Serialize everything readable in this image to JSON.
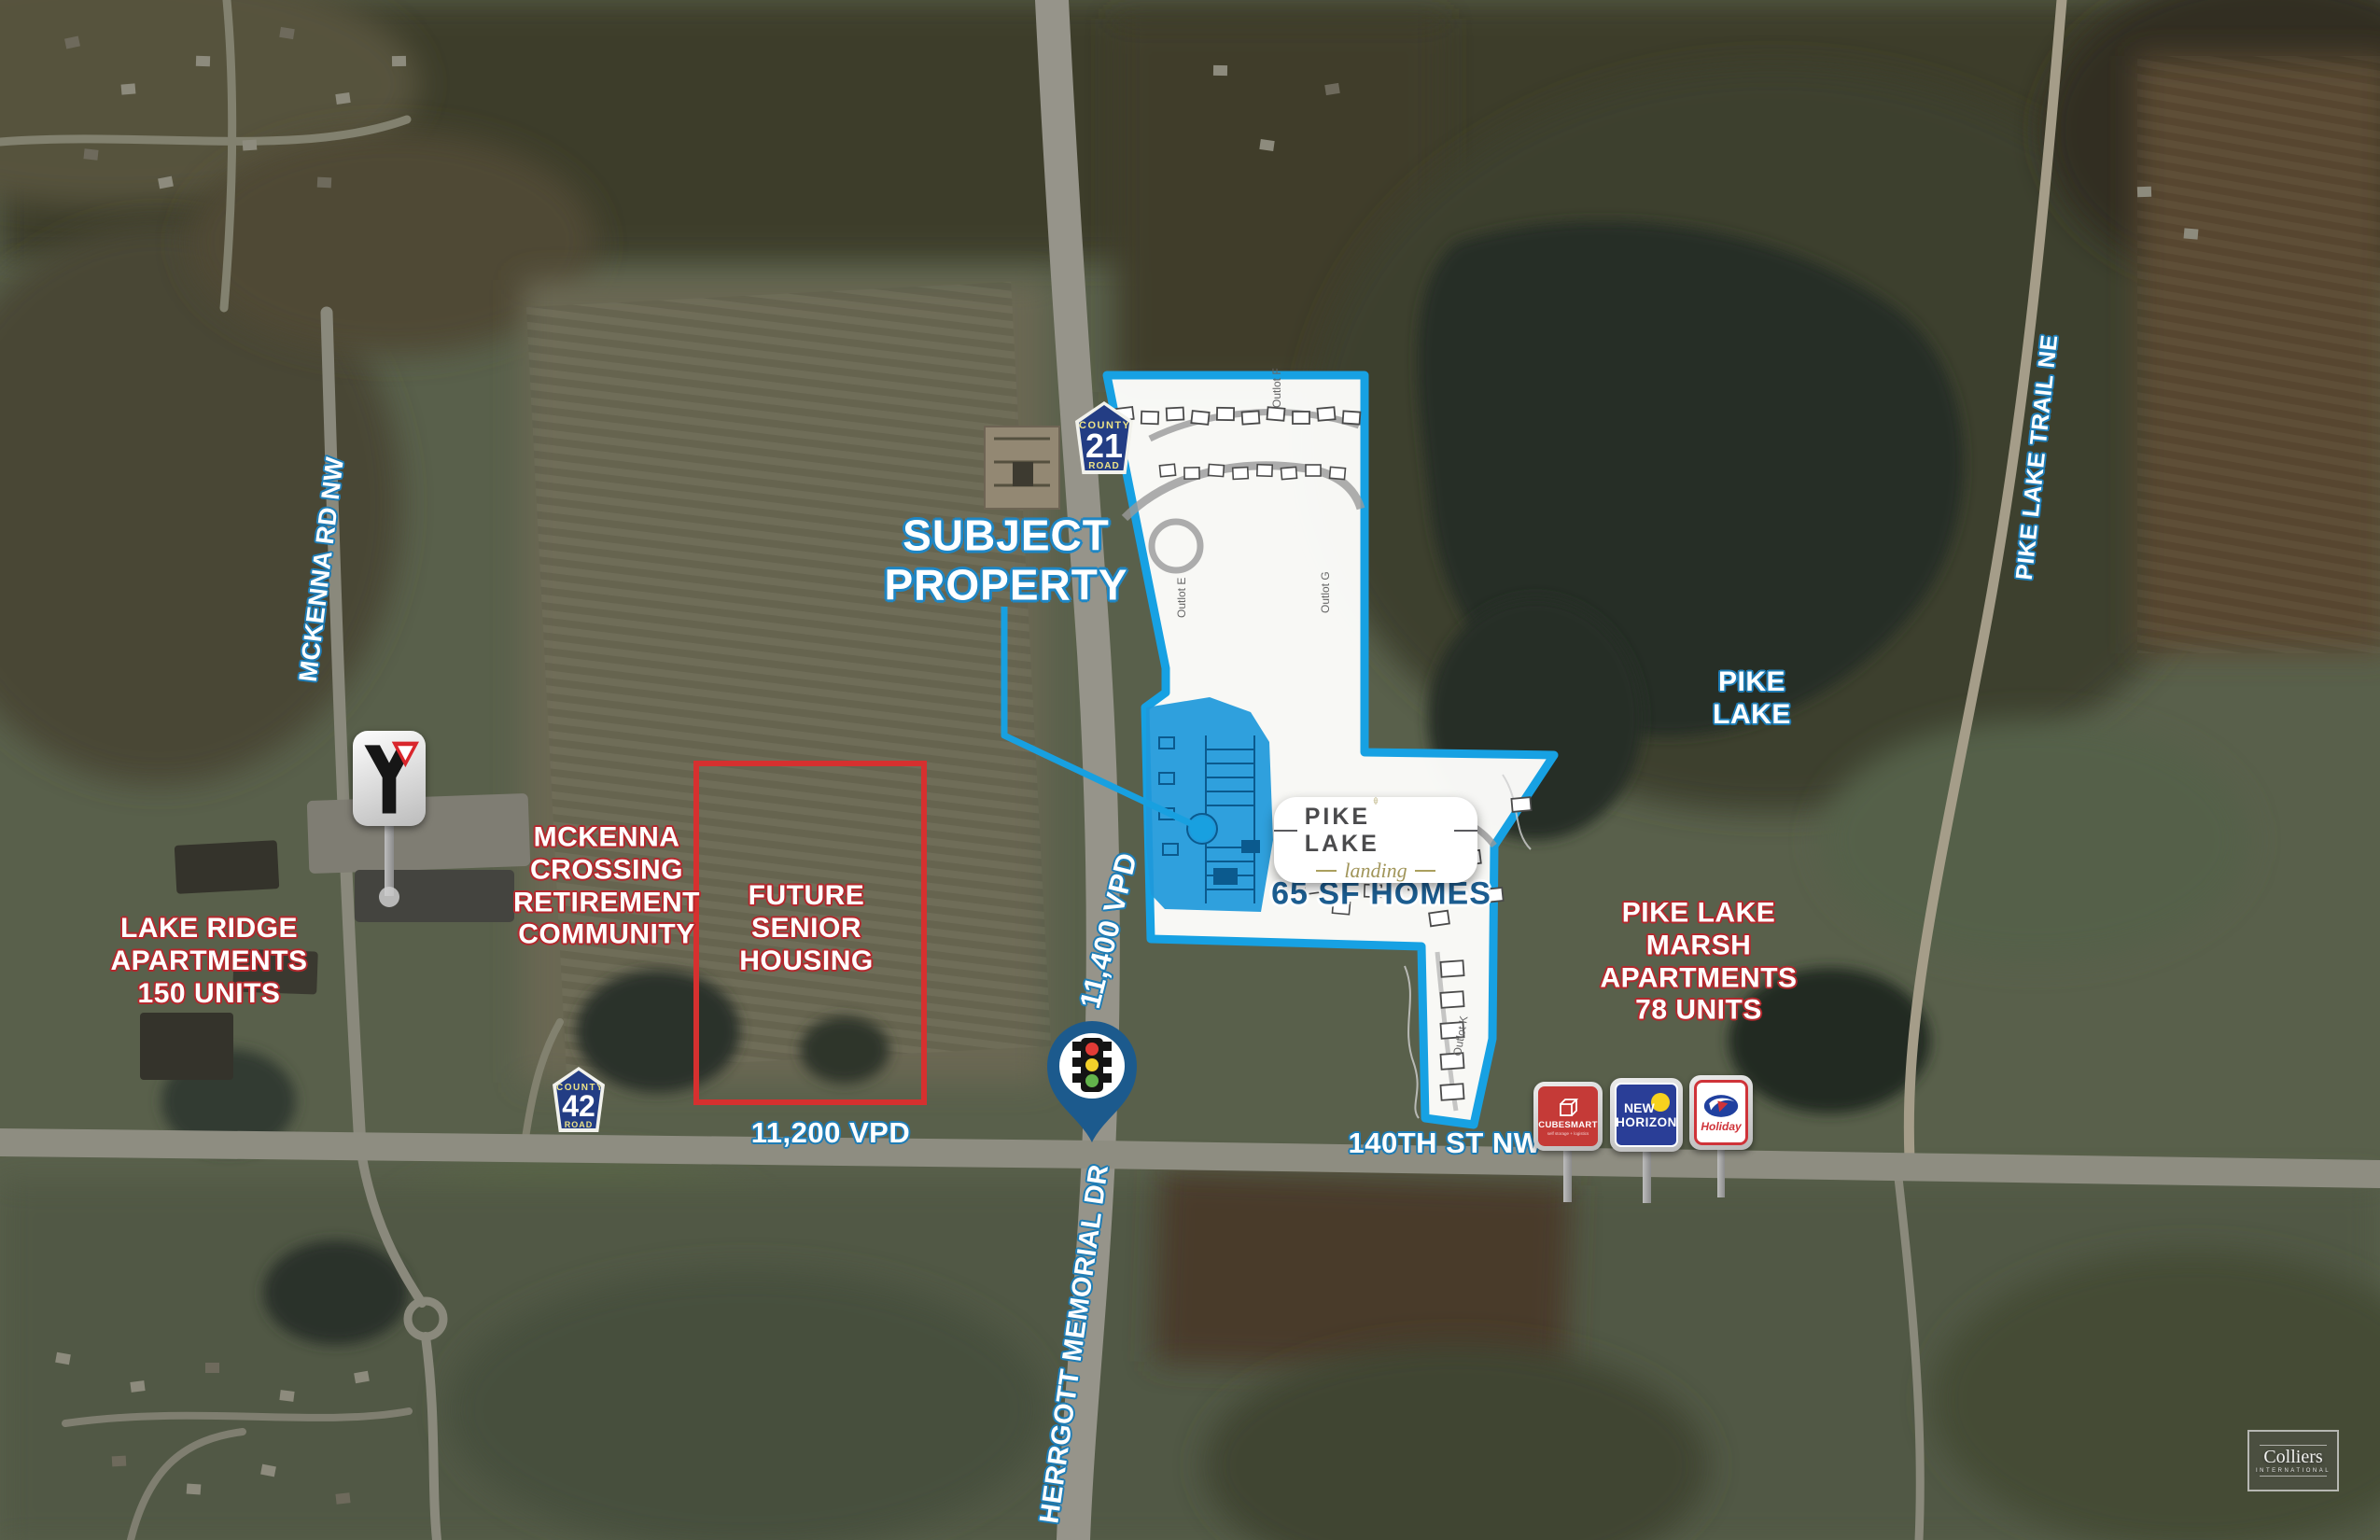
{
  "annotations": {
    "subject": "SUBJECT\nPROPERTY",
    "vpd_hwy21": "11,400 VPD",
    "vpd_140th": "11,200 VPD",
    "street_140th": "140TH ST NW",
    "herrgott": "HERRGOTT MEMORIAL DR",
    "mckenna_rd": "MCKENNA RD NW",
    "pike_lake_trail": "PIKE LAKE TRAIL NE",
    "pike_lake": "PIKE\nLAKE",
    "lake_ridge": "LAKE RIDGE\nAPARTMENTS\n150 UNITS",
    "mckenna_crossing": "MCKENNA\nCROSSING\nRETIREMENT\nCOMMUNITY",
    "future_senior": "FUTURE\nSENIOR\nHOUSING",
    "pike_lake_marsh": "PIKE LAKE\nMARSH\nAPARTMENTS\n78 UNITS"
  },
  "shields": {
    "route21": {
      "county": "COUNTY",
      "number": "21",
      "road": "ROAD"
    },
    "route42": {
      "county": "COUNTY",
      "number": "42",
      "road": "ROAD"
    }
  },
  "siteplan": {
    "logo_title": "PIKE LAKE",
    "logo_script": "landing",
    "homes": "65 SF HOMES",
    "outlots": [
      "Outlot E",
      "Outlot F",
      "Outlot G",
      "Outlot K"
    ]
  },
  "signs": {
    "ymca": "Y",
    "cubesmart": {
      "name": "CUBESMART",
      "tagline": "self storage + logistics"
    },
    "new_horizon": {
      "line1": "NEW",
      "line2": "HORIZON"
    },
    "holiday": "Holiday"
  },
  "watermark": {
    "name": "Colliers",
    "sub": "INTERNATIONAL"
  },
  "colors": {
    "accent_blue": "#18a0e0",
    "label_outline_blue": "#1e7cb5",
    "label_outline_red": "#b3282d",
    "shield_blue": "#233d84",
    "red_box": "#d6302f",
    "pin_blue": "#1c5a8d"
  }
}
